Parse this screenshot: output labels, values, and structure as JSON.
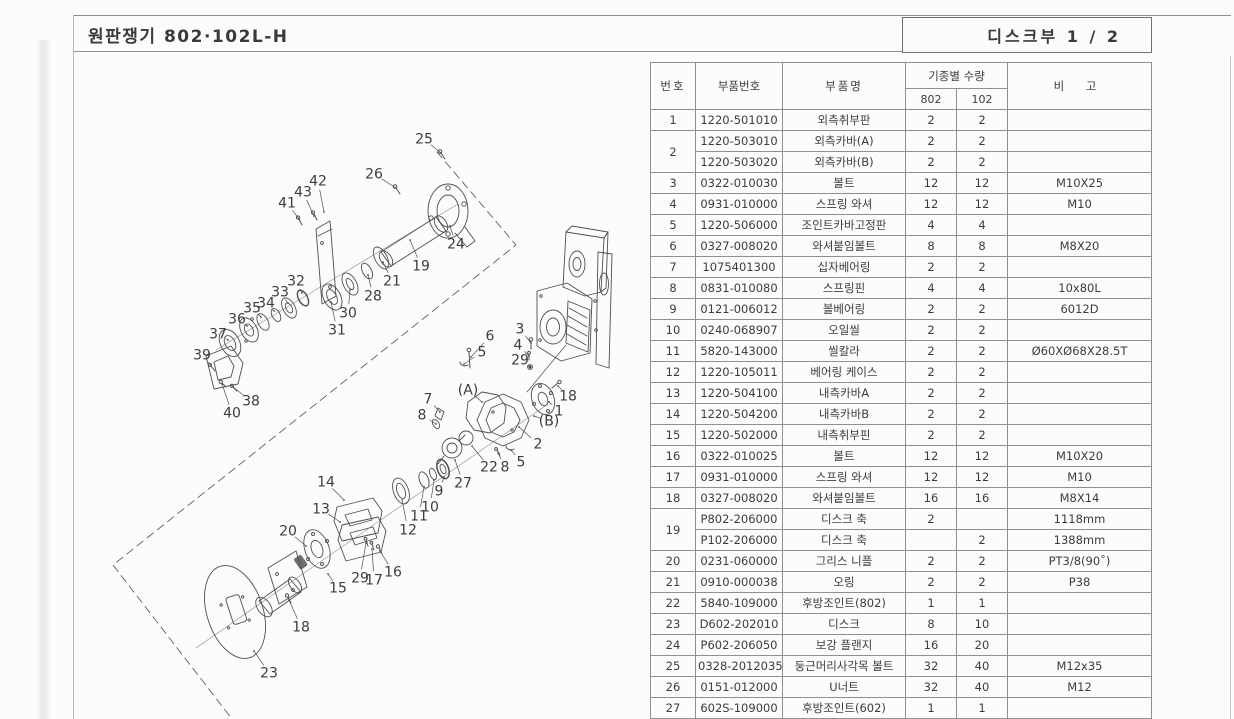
{
  "page": {
    "title": "원판쟁기 802·102L-H",
    "section_label": "디스크부  1 / 2"
  },
  "table": {
    "headers": {
      "no": "번호",
      "part_no": "부품번호",
      "part_name": "부품명",
      "qty_group": "기종별 수량",
      "model_a": "802",
      "model_b": "102",
      "remark": "비 고"
    },
    "rows": [
      {
        "no": "1",
        "span": 1,
        "part_no": "1220-501010",
        "name": "외측취부판",
        "q802": "2",
        "q102": "2",
        "remark": ""
      },
      {
        "no": "2",
        "span": 2,
        "part_no": "1220-503010",
        "name": "외측카바(A)",
        "q802": "2",
        "q102": "2",
        "remark": ""
      },
      {
        "no": "",
        "span": 0,
        "part_no": "1220-503020",
        "name": "외측카바(B)",
        "q802": "2",
        "q102": "2",
        "remark": ""
      },
      {
        "no": "3",
        "span": 1,
        "part_no": "0322-010030",
        "name": "볼트",
        "q802": "12",
        "q102": "12",
        "remark": "M10X25"
      },
      {
        "no": "4",
        "span": 1,
        "part_no": "0931-010000",
        "name": "스프링 와셔",
        "q802": "12",
        "q102": "12",
        "remark": "M10"
      },
      {
        "no": "5",
        "span": 1,
        "part_no": "1220-506000",
        "name": "조인트카바고정판",
        "q802": "4",
        "q102": "4",
        "remark": ""
      },
      {
        "no": "6",
        "span": 1,
        "part_no": "0327-008020",
        "name": "와셔붙임볼트",
        "q802": "8",
        "q102": "8",
        "remark": "M8X20"
      },
      {
        "no": "7",
        "span": 1,
        "part_no": "1075401300",
        "name": "십자베어링",
        "q802": "2",
        "q102": "2",
        "remark": ""
      },
      {
        "no": "8",
        "span": 1,
        "part_no": "0831-010080",
        "name": "스프링핀",
        "q802": "4",
        "q102": "4",
        "remark": "10x80L"
      },
      {
        "no": "9",
        "span": 1,
        "part_no": "0121-006012",
        "name": "볼베어링",
        "q802": "2",
        "q102": "2",
        "remark": "6012D"
      },
      {
        "no": "10",
        "span": 1,
        "part_no": "0240-068907",
        "name": "오일씰",
        "q802": "2",
        "q102": "2",
        "remark": ""
      },
      {
        "no": "11",
        "span": 1,
        "part_no": "5820-143000",
        "name": "씰칼라",
        "q802": "2",
        "q102": "2",
        "remark": "Ø60XØ68X28.5T"
      },
      {
        "no": "12",
        "span": 1,
        "part_no": "1220-105011",
        "name": "베어링 케이스",
        "q802": "2",
        "q102": "2",
        "remark": ""
      },
      {
        "no": "13",
        "span": 1,
        "part_no": "1220-504100",
        "name": "내측카바A",
        "q802": "2",
        "q102": "2",
        "remark": ""
      },
      {
        "no": "14",
        "span": 1,
        "part_no": "1220-504200",
        "name": "내측카바B",
        "q802": "2",
        "q102": "2",
        "remark": ""
      },
      {
        "no": "15",
        "span": 1,
        "part_no": "1220-502000",
        "name": "내측취부핀",
        "q802": "2",
        "q102": "2",
        "remark": ""
      },
      {
        "no": "16",
        "span": 1,
        "part_no": "0322-010025",
        "name": "볼트",
        "q802": "12",
        "q102": "12",
        "remark": "M10X20"
      },
      {
        "no": "17",
        "span": 1,
        "part_no": "0931-010000",
        "name": "스프링 와셔",
        "q802": "12",
        "q102": "12",
        "remark": "M10"
      },
      {
        "no": "18",
        "span": 1,
        "part_no": "0327-008020",
        "name": "와셔붙임볼트",
        "q802": "16",
        "q102": "16",
        "remark": "M8X14"
      },
      {
        "no": "19",
        "span": 2,
        "part_no": "P802-206000",
        "name": "디스크 축",
        "q802": "2",
        "q102": "",
        "remark": "1118mm"
      },
      {
        "no": "",
        "span": 0,
        "part_no": "P102-206000",
        "name": "디스크 축",
        "q802": "",
        "q102": "2",
        "remark": "1388mm"
      },
      {
        "no": "20",
        "span": 1,
        "part_no": "0231-060000",
        "name": "그리스 니플",
        "q802": "2",
        "q102": "2",
        "remark": "PT3/8(90˚)"
      },
      {
        "no": "21",
        "span": 1,
        "part_no": "0910-000038",
        "name": "오링",
        "q802": "2",
        "q102": "2",
        "remark": "P38"
      },
      {
        "no": "22",
        "span": 1,
        "part_no": "5840-109000",
        "name": "후방조인트(802)",
        "q802": "1",
        "q102": "1",
        "remark": ""
      },
      {
        "no": "23",
        "span": 1,
        "part_no": "D602-202010",
        "name": "디스크",
        "q802": "8",
        "q102": "10",
        "remark": ""
      },
      {
        "no": "24",
        "span": 1,
        "part_no": "P602-206050",
        "name": "보강 플랜지",
        "q802": "16",
        "q102": "20",
        "remark": ""
      },
      {
        "no": "25",
        "span": 1,
        "part_no": "0328-2012035",
        "name": "둥근머리사각목 볼트",
        "q802": "32",
        "q102": "40",
        "remark": "M12x35"
      },
      {
        "no": "26",
        "span": 1,
        "part_no": "0151-012000",
        "name": "U너트",
        "q802": "32",
        "q102": "40",
        "remark": "M12"
      },
      {
        "no": "27",
        "span": 1,
        "part_no": "602S-109000",
        "name": "후방조인트(602)",
        "q802": "1",
        "q102": "1",
        "remark": ""
      }
    ]
  },
  "diagram": {
    "callouts": [
      {
        "t": "25",
        "x": 424,
        "y": 139,
        "tx": 441,
        "ty": 153
      },
      {
        "t": "26",
        "x": 374,
        "y": 174,
        "tx": 396,
        "ty": 188
      },
      {
        "t": "42",
        "x": 318,
        "y": 181,
        "tx": 324,
        "ty": 212
      },
      {
        "t": "43",
        "x": 303,
        "y": 192,
        "tx": 314,
        "ty": 216
      },
      {
        "t": "41",
        "x": 287,
        "y": 203,
        "tx": 299,
        "ty": 219
      },
      {
        "t": "24",
        "x": 456,
        "y": 244,
        "tx": 450,
        "ty": 226
      },
      {
        "t": "19",
        "x": 421,
        "y": 266,
        "tx": 410,
        "ty": 240
      },
      {
        "t": "21",
        "x": 392,
        "y": 281,
        "tx": 383,
        "ty": 262
      },
      {
        "t": "28",
        "x": 373,
        "y": 296,
        "tx": 368,
        "ty": 275
      },
      {
        "t": "30",
        "x": 348,
        "y": 313,
        "tx": 350,
        "ty": 290
      },
      {
        "t": "31",
        "x": 337,
        "y": 330,
        "tx": 331,
        "ty": 302
      },
      {
        "t": "32",
        "x": 296,
        "y": 281,
        "tx": 302,
        "ty": 293
      },
      {
        "t": "33",
        "x": 280,
        "y": 292,
        "tx": 288,
        "ty": 303
      },
      {
        "t": "34",
        "x": 266,
        "y": 303,
        "tx": 274,
        "ty": 311
      },
      {
        "t": "35",
        "x": 252,
        "y": 308,
        "tx": 261,
        "ty": 317
      },
      {
        "t": "36",
        "x": 237,
        "y": 319,
        "tx": 247,
        "ty": 326
      },
      {
        "t": "37",
        "x": 218,
        "y": 334,
        "tx": 228,
        "ty": 340
      },
      {
        "t": "39",
        "x": 202,
        "y": 355,
        "tx": 211,
        "ty": 366
      },
      {
        "t": "38",
        "x": 251,
        "y": 401,
        "tx": 233,
        "ty": 387
      },
      {
        "t": "40",
        "x": 232,
        "y": 413,
        "tx": 222,
        "ty": 384
      },
      {
        "t": "6",
        "x": 490,
        "y": 336,
        "tx": 471,
        "ty": 357
      },
      {
        "t": "3",
        "x": 520,
        "y": 329,
        "tx": 531,
        "ty": 343
      },
      {
        "t": "4",
        "x": 518,
        "y": 345,
        "tx": 529,
        "ty": 356
      },
      {
        "t": "5",
        "x": 482,
        "y": 352,
        "tx": 464,
        "ty": 364
      },
      {
        "t": "29",
        "x": 520,
        "y": 360,
        "tx": 530,
        "ty": 367
      },
      {
        "t": "(A)",
        "x": 468,
        "y": 390,
        "tx": 482,
        "ty": 402
      },
      {
        "t": "18",
        "x": 568,
        "y": 396,
        "tx": 558,
        "ty": 386
      },
      {
        "t": "1",
        "x": 559,
        "y": 411,
        "tx": 549,
        "ty": 402
      },
      {
        "t": "(B)",
        "x": 549,
        "y": 421,
        "tx": 534,
        "ty": 416
      },
      {
        "t": "2",
        "x": 538,
        "y": 444,
        "tx": 519,
        "ty": 427
      },
      {
        "t": "5",
        "x": 521,
        "y": 462,
        "tx": 511,
        "ty": 450
      },
      {
        "t": "8",
        "x": 505,
        "y": 467,
        "tx": 498,
        "ty": 453
      },
      {
        "t": "22",
        "x": 489,
        "y": 467,
        "tx": 472,
        "ty": 446
      },
      {
        "t": "27",
        "x": 463,
        "y": 483,
        "tx": 455,
        "ty": 460
      },
      {
        "t": "7",
        "x": 428,
        "y": 399,
        "tx": 440,
        "ty": 412
      },
      {
        "t": "8",
        "x": 422,
        "y": 415,
        "tx": 436,
        "ty": 424
      },
      {
        "t": "9",
        "x": 439,
        "y": 491,
        "tx": 444,
        "ty": 477
      },
      {
        "t": "10",
        "x": 430,
        "y": 507,
        "tx": 434,
        "ty": 480
      },
      {
        "t": "11",
        "x": 419,
        "y": 516,
        "tx": 424,
        "ty": 487
      },
      {
        "t": "12",
        "x": 408,
        "y": 530,
        "tx": 402,
        "ty": 500
      },
      {
        "t": "14",
        "x": 326,
        "y": 482,
        "tx": 344,
        "ty": 500
      },
      {
        "t": "13",
        "x": 321,
        "y": 509,
        "tx": 340,
        "ty": 522
      },
      {
        "t": "20",
        "x": 288,
        "y": 531,
        "tx": 306,
        "ty": 546
      },
      {
        "t": "16",
        "x": 393,
        "y": 572,
        "tx": 380,
        "ty": 551
      },
      {
        "t": "17",
        "x": 374,
        "y": 580,
        "tx": 372,
        "ty": 549
      },
      {
        "t": "29",
        "x": 360,
        "y": 578,
        "tx": 366,
        "ty": 543
      },
      {
        "t": "15",
        "x": 338,
        "y": 588,
        "tx": 328,
        "ty": 574
      },
      {
        "t": "18",
        "x": 301,
        "y": 627,
        "tx": 289,
        "ty": 600
      },
      {
        "t": "23",
        "x": 269,
        "y": 673,
        "tx": 254,
        "ty": 651
      }
    ]
  }
}
